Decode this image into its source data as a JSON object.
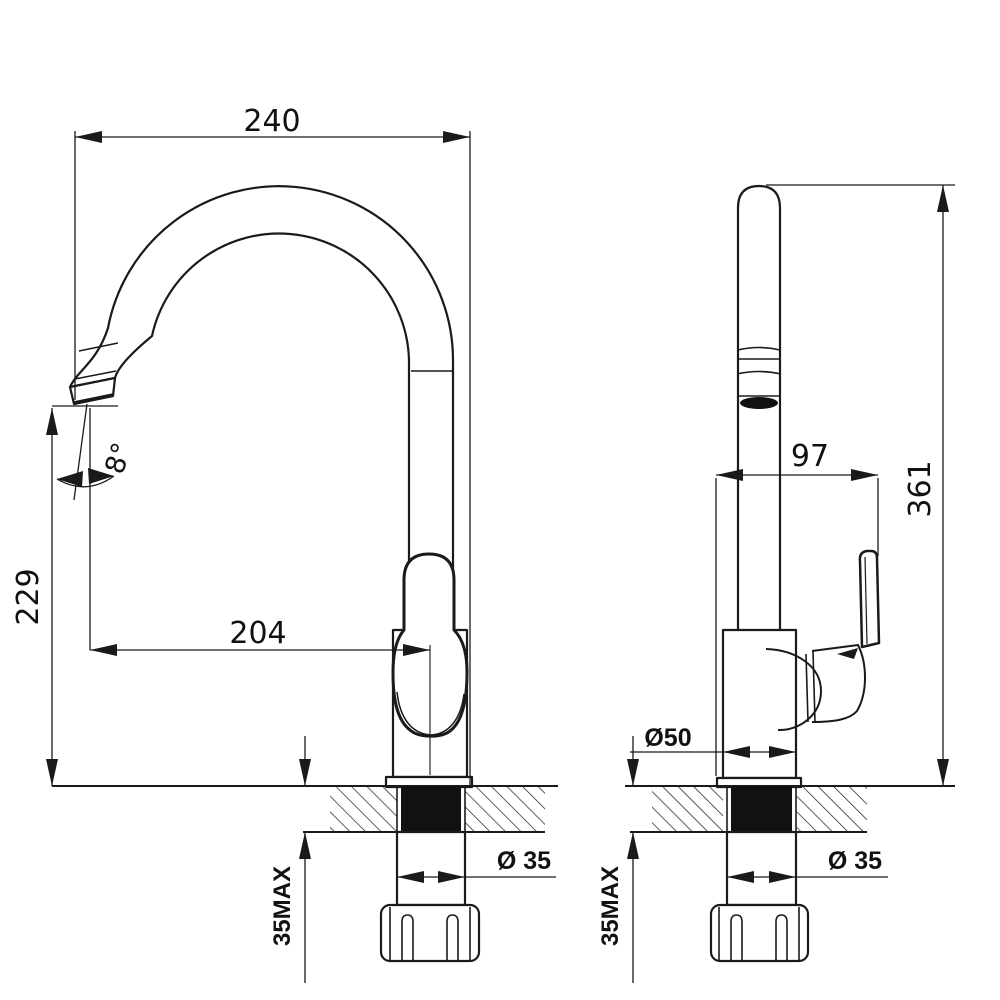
{
  "drawing": {
    "description": "Kitchen sink mixer tap — dimensioned installation drawing with front and side orthographic views",
    "line_color": "#1a1a1a",
    "background": "#ffffff",
    "front_view": {
      "overall_width_mm": "240",
      "height_to_spout_outlet_mm": "229",
      "spout_reach_mm": "204",
      "outlet_angle": "8°",
      "max_deck_thickness": "35MAX",
      "mounting_hole_diameter": "Ø 35"
    },
    "side_view": {
      "depth_mm": "97",
      "overall_height_mm": "361",
      "base_diameter": "Ø50",
      "max_deck_thickness": "35MAX",
      "mounting_hole_diameter": "Ø 35"
    }
  }
}
